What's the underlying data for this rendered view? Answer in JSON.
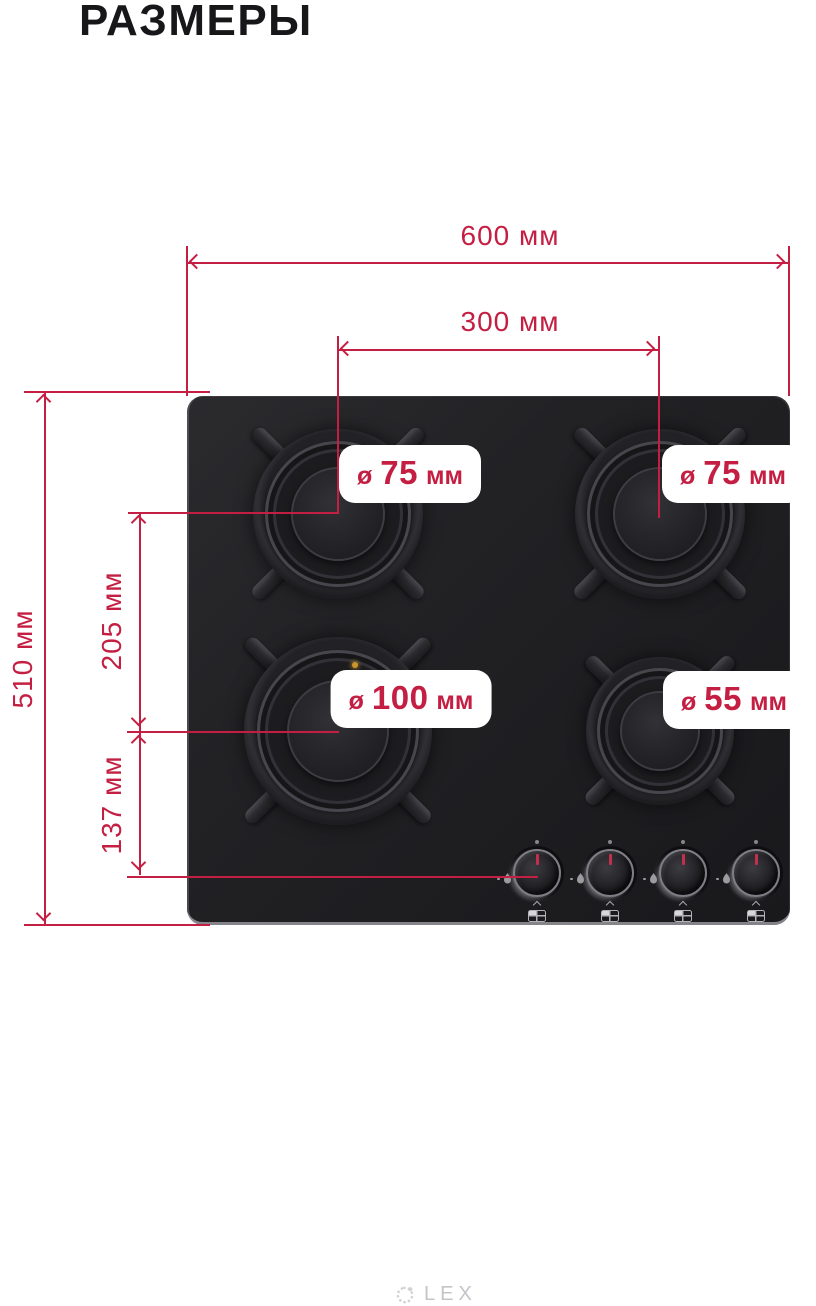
{
  "title": "РАЗМЕРЫ",
  "dims": {
    "width": "600 мм",
    "burner_spacing": "300 мм",
    "depth": "510 мм",
    "row_spacing": "205 мм",
    "front_offset": "137 мм"
  },
  "burners": [
    {
      "position": "top-left",
      "prefix": "ø",
      "value": "75",
      "unit": "мм"
    },
    {
      "position": "top-right",
      "prefix": "ø",
      "value": "75",
      "unit": "мм"
    },
    {
      "position": "bottom-left",
      "prefix": "ø",
      "value": "100",
      "unit": "мм"
    },
    {
      "position": "bottom-right",
      "prefix": "ø",
      "value": "55",
      "unit": "мм"
    }
  ],
  "brand": "LEX",
  "colors": {
    "accent": "#C41F42",
    "surface": "#1E1E21"
  }
}
